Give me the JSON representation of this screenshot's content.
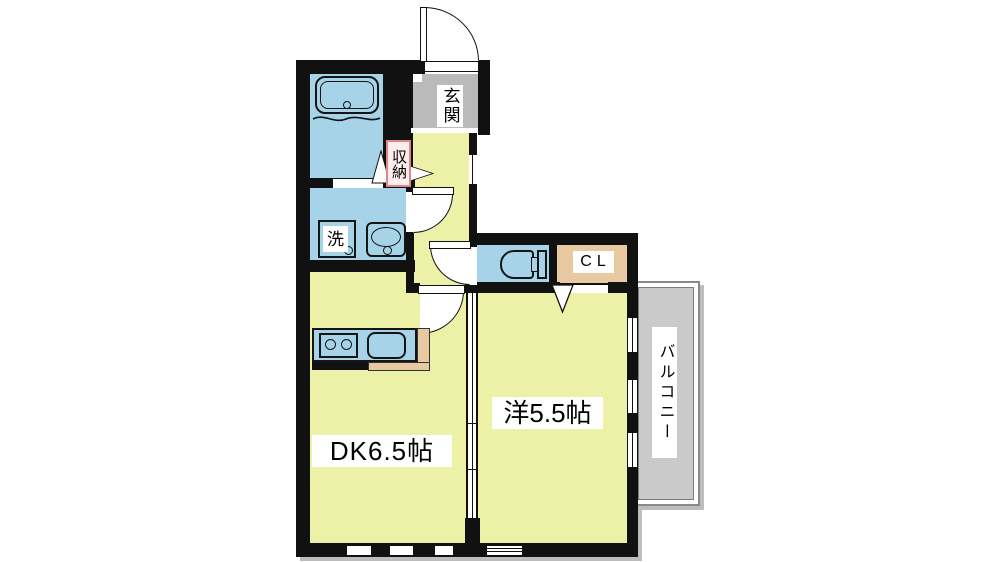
{
  "floorplan": {
    "labels": {
      "entrance": "玄関",
      "storage": "収納",
      "laundry": "洗",
      "closet": "CL",
      "dining_kitchen": "DK6.5帖",
      "western_room": "洋5.5帖",
      "balcony": "バルコニー"
    },
    "colors": {
      "wall": "#111111",
      "room_yellow": "#edf0a7",
      "wet_blue": "#a6d3e7",
      "entrance_gray": "#bababa",
      "balcony_gray": "#cacaca",
      "closet_tan": "#e9c9a1",
      "counter_tan": "#e9c9a1",
      "storage_label_bg": "#fdeded",
      "storage_label_border": "#e0868d",
      "shadow": "#bdbdbd"
    }
  }
}
